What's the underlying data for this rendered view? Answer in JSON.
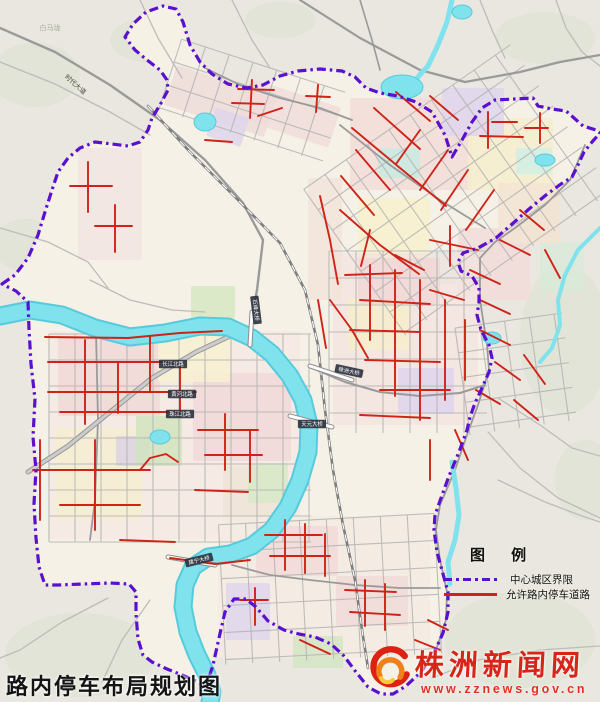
{
  "page": {
    "title": "路内停车布局规划图"
  },
  "legend": {
    "heading": "图 例",
    "items": [
      {
        "label": "中心城区界限",
        "type": "boundary"
      },
      {
        "label": "允许路内停车道路",
        "type": "parking-road"
      }
    ]
  },
  "watermark": {
    "site_name": "株洲新闻网",
    "url": "www.zznews.gov.cn"
  },
  "colors": {
    "bg_rural": "#e9e7e0",
    "blob": "#dee4d3",
    "urban_base": "#f7f2e7",
    "water_edge": "#55cbdb",
    "water": "#7fe2ec",
    "grid": "#b3b3b3",
    "rural_road": "#bcbcbc",
    "major_road": "#9a9a9a",
    "railway": "#7e7e7e",
    "red": "#cf2318",
    "boundary": "#5a10cf",
    "plate_bg": "#2e3440",
    "plate_text": "#ffffff"
  },
  "map": {
    "rural_blobs": [
      [
        35,
        75,
        45,
        32
      ],
      [
        95,
        195,
        38,
        48
      ],
      [
        25,
        245,
        32,
        26
      ],
      [
        150,
        40,
        40,
        22
      ],
      [
        545,
        38,
        50,
        26
      ],
      [
        565,
        340,
        45,
        75
      ],
      [
        520,
        640,
        75,
        48
      ],
      [
        80,
        655,
        75,
        42
      ],
      [
        585,
        480,
        30,
        40
      ],
      [
        280,
        20,
        35,
        18
      ]
    ],
    "boundary_path": "M2,284 L15,275 28,258 38,235 45,212 52,190 58,172 68,158 80,148 95,142 112,144 128,146 140,142 148,130 152,118 160,105 168,90 167,80 160,70 147,60 135,50 125,37 133,24 146,12 163,6 176,9 183,22 190,45 200,62 212,74 228,84 247,88 263,85 280,76 298,71 320,69 342,71 355,77 366,88 380,93 398,96 416,102 432,112 445,135 452,157 462,140 472,122 482,108 495,100 515,99 533,98 538,106 552,109 566,111 574,118 583,126 596,130 600,133 592,142 584,152 578,165 572,177 561,184 546,195 529,209 511,225 496,238 478,248 463,253 458,262 461,271 472,276 479,288 479,302 477,315 481,330 489,345 492,358 489,372 482,388 475,403 470,417 467,430 459,452 449,476 441,498 435,515 434,530 437,552 443,574 448,592 448,612 443,633 433,655 420,673 406,686 393,694 381,694 368,687 356,672 344,656 331,644 315,637 299,634 284,630 268,621 256,607 246,599 234,599 225,612 219,638 213,665 206,687 196,681 182,675 167,669 152,662 143,655 138,639 136,614 136,592 129,584 110,583 83,584 58,585 45,585 39,567 36,538 34,504 36,470 33,437 35,399 31,364 29,329 28,302 16,291 4,285 Z",
    "zones": [
      [
        350,
        98,
        122,
        92,
        "#f3dcd8",
        0
      ],
      [
        468,
        118,
        85,
        72,
        "#f6eecb",
        0
      ],
      [
        442,
        88,
        62,
        48,
        "#ded4ef",
        0
      ],
      [
        378,
        148,
        42,
        30,
        "#c6ebe2",
        0
      ],
      [
        424,
        252,
        46,
        32,
        "#c6ebe2",
        0
      ],
      [
        516,
        148,
        36,
        26,
        "#cfeee6",
        0
      ],
      [
        540,
        242,
        44,
        48,
        "#d9ead8",
        0
      ],
      [
        358,
        198,
        72,
        62,
        "#f7f0cc",
        0
      ],
      [
        458,
        228,
        72,
        72,
        "#f2dcda",
        0
      ],
      [
        498,
        183,
        62,
        60,
        "#f4e3d2",
        0
      ],
      [
        168,
        80,
        105,
        42,
        "#eedcda",
        18
      ],
      [
        242,
        92,
        95,
        42,
        "#f0dcda",
        18
      ],
      [
        210,
        112,
        36,
        30,
        "#ddd4ec",
        18
      ],
      [
        333,
        253,
        145,
        172,
        "#f4e4df",
        0
      ],
      [
        348,
        298,
        62,
        52,
        "#f6efcd",
        0
      ],
      [
        398,
        368,
        56,
        46,
        "#ded5ee",
        0
      ],
      [
        358,
        258,
        82,
        46,
        "#f0d7d5",
        0
      ],
      [
        48,
        331,
        252,
        208,
        "#f5e9e4",
        0
      ],
      [
        58,
        338,
        102,
        78,
        "#f1d8d6",
        0
      ],
      [
        193,
        373,
        98,
        88,
        "#f0d8d8",
        0
      ],
      [
        158,
        336,
        72,
        46,
        "#f7f1cf",
        0
      ],
      [
        56,
        428,
        86,
        92,
        "#f6efcf",
        0
      ],
      [
        116,
        436,
        34,
        30,
        "#d9d2e4",
        0
      ],
      [
        223,
        466,
        62,
        56,
        "#efe3d6",
        0
      ],
      [
        136,
        416,
        46,
        50,
        "#cfe4bd",
        0
      ],
      [
        191,
        286,
        44,
        34,
        "#d4e7c2",
        0
      ],
      [
        248,
        463,
        40,
        40,
        "#d6e8c4",
        0
      ],
      [
        218,
        516,
        212,
        142,
        "#f4ebe2",
        0
      ],
      [
        256,
        526,
        82,
        50,
        "#f1dad8",
        0
      ],
      [
        336,
        576,
        72,
        50,
        "#f0d9d7",
        0
      ],
      [
        226,
        583,
        44,
        57,
        "#ddd5ec",
        0
      ],
      [
        293,
        636,
        50,
        32,
        "#d2e5c3",
        0
      ],
      [
        308,
        178,
        34,
        122,
        "#f3e3da",
        0
      ],
      [
        78,
        148,
        64,
        112,
        "#f2e5e2",
        0
      ]
    ],
    "grids": [
      {
        "cx": 180,
        "cy": 438,
        "w": 262,
        "h": 208,
        "dx": 26,
        "dy": 26,
        "rot": 0
      },
      {
        "cx": 408,
        "cy": 342,
        "w": 158,
        "h": 182,
        "dx": 27,
        "dy": 27,
        "rot": 0
      },
      {
        "cx": 458,
        "cy": 190,
        "w": 252,
        "h": 178,
        "dx": 26,
        "dy": 25,
        "rot": -35
      },
      {
        "cx": 252,
        "cy": 101,
        "w": 172,
        "h": 74,
        "dx": 25,
        "dy": 24,
        "rot": 18
      },
      {
        "cx": 330,
        "cy": 589,
        "w": 216,
        "h": 140,
        "dx": 27,
        "dy": 27,
        "rot": -3
      },
      {
        "cx": 516,
        "cy": 374,
        "w": 108,
        "h": 108,
        "dx": 25,
        "dy": 25,
        "rot": -8
      }
    ],
    "rural_roads": [
      "0,62 55,84 110,112 150,135",
      "0,228 48,242 88,262 108,288",
      "140,0 158,38 182,78",
      "232,0 252,40 270,68",
      "480,0 492,30 505,58",
      "556,0 566,28 582,52 600,66",
      "488,432 520,468 558,498 600,518",
      "432,678 478,660 540,650 600,646",
      "108,598 62,622 20,650 0,658",
      "150,600 122,640 102,682",
      "90,280 130,300 172,310 205,312",
      "498,398 540,425 572,448 600,456",
      "498,480 545,502 582,516 600,522"
    ],
    "major_roads": [
      {
        "p": "0,28 55,52 110,85 160,120 205,160 243,203 263,240 257,290 252,318",
        "w": 2.4
      },
      {
        "p": "300,0 360,38 420,70 465,82 520,72 560,62 600,55",
        "w": 2.2
      },
      {
        "p": "585,145 570,180 545,205 515,228 495,242 480,258 480,300 487,345 489,370 478,405 468,432 455,470 440,505 436,530 440,560 447,592 446,620 436,650 420,672",
        "w": 1.8
      },
      {
        "p": "312,368 345,382 380,392 420,396 460,393 485,385",
        "w": 2
      },
      {
        "p": "96,332 98,420 95,500 90,540",
        "w": 1.8
      },
      {
        "p": "232,565 270,575 310,580 355,585 400,588 440,588",
        "w": 1.8
      },
      {
        "p": "205,68 240,85 280,98 320,108 352,120",
        "w": 1.8
      },
      {
        "p": "340,125 390,165 440,200 485,228",
        "w": 1.8
      },
      {
        "p": "360,0 372,40 380,70",
        "w": 1.6
      }
    ],
    "expressway": {
      "p": "28,472 68,446 110,412 152,378 196,352 230,336",
      "casing": "#999999",
      "fill_c": "#cccccc"
    },
    "railway": "148,106 190,152 238,200 280,243 305,290 318,345 325,410 333,470 343,525 355,580 362,630 368,668",
    "water": {
      "river": "0,316 30,310 62,315 95,328 130,337 165,333 200,326 228,327 252,338 272,354 290,376 303,400 309,425 308,452 300,480 288,507 272,530 252,546 230,554 208,557 193,567 185,585 183,607 188,632 197,655 207,675 212,692 210,702",
      "streams": [
        {
          "p": "600,228 578,250 565,275 558,300 560,325 552,348 540,362",
          "w": 4
        },
        {
          "p": "452,462 456,488 459,515 455,540 448,562 450,584",
          "w": 5
        },
        {
          "p": "452,0 447,22 438,45 428,66 416,79",
          "w": 5
        }
      ],
      "ponds": [
        [
          402,
          87,
          21,
          12
        ],
        [
          205,
          122,
          11,
          9
        ],
        [
          462,
          12,
          10,
          7
        ],
        [
          160,
          437,
          10,
          7
        ],
        [
          492,
          338,
          9,
          6
        ],
        [
          545,
          160,
          10,
          6
        ]
      ]
    },
    "bridges": [
      "252,312 250,345",
      "310,366 352,380",
      "290,416 332,427",
      "168,557 215,565"
    ],
    "red_roads": [
      "45,337 128,338 180,333 222,331",
      "48,362 178,362",
      "48,392 196,392",
      "60,412 190,412",
      "85,340 85,424",
      "118,362 118,413",
      "150,337 150,392",
      "180,362 180,413",
      "60,470 150,470",
      "95,440 95,530",
      "60,505 140,505",
      "140,470 150,458 166,454 178,462",
      "198,430 258,430",
      "205,455 262,455",
      "225,414 225,470",
      "250,430 250,482",
      "195,490 248,492",
      "40,440 40,520",
      "33,470 60,470",
      "88,162 88,212",
      "70,186 112,186",
      "95,226 132,226",
      "115,205 115,252",
      "205,140 232,142",
      "120,540 175,542",
      "252,80 250,118",
      "238,89 274,90",
      "232,103 264,104",
      "258,116 282,108",
      "318,85 316,112",
      "306,96 330,97",
      "352,128 400,168 446,206",
      "374,108 420,149",
      "396,92 430,121",
      "420,130 396,164",
      "448,150 420,190",
      "468,170 441,210",
      "494,190 466,230",
      "356,150 390,190",
      "341,176 374,215",
      "430,96 458,120",
      "480,136 523,137",
      "492,122 517,122",
      "488,112 488,148",
      "540,113 540,143",
      "525,128 548,128",
      "340,210 380,245 419,274",
      "370,230 361,266",
      "395,255 424,270",
      "430,240 478,250",
      "450,226 450,266",
      "470,270 500,284",
      "500,240 530,255",
      "520,210 544,230",
      "545,250 560,278",
      "480,300 510,314",
      "430,290 464,300",
      "345,275 402,273",
      "360,300 430,304",
      "350,330 420,332",
      "365,360 440,362",
      "380,390 450,390",
      "360,415 430,418",
      "370,265 370,340",
      "395,270 395,396",
      "420,280 420,420",
      "445,300 445,400",
      "465,320 465,380",
      "330,300 352,330 368,358",
      "320,196 330,240 338,284",
      "318,300 326,348",
      "455,430 468,460",
      "430,440 430,480",
      "480,330 510,345",
      "495,362 520,380",
      "476,390 500,404",
      "524,355 545,384",
      "514,400 538,420",
      "170,558 215,564 250,560",
      "265,535 322,535",
      "270,556 330,556",
      "285,520 285,570",
      "305,524 305,573",
      "325,534 325,576",
      "345,590 396,592",
      "350,612 400,615",
      "365,580 365,626",
      "385,584 385,630",
      "240,600 268,600",
      "255,588 255,625",
      "300,640 330,654",
      "415,640 440,650",
      "428,620 448,630"
    ],
    "plates": [
      {
        "t": "长江北路",
        "x": 173,
        "y": 364,
        "r": 0
      },
      {
        "t": "黄河北路",
        "x": 182,
        "y": 394,
        "r": 0
      },
      {
        "t": "珠江北路",
        "x": 180,
        "y": 414,
        "r": 0
      },
      {
        "t": "株洲大桥",
        "x": 349,
        "y": 371,
        "r": 12
      },
      {
        "t": "天元大桥",
        "x": 312,
        "y": 424,
        "r": 0
      },
      {
        "t": "建宁大桥",
        "x": 199,
        "y": 560,
        "r": -14
      },
      {
        "t": "石峰大桥",
        "x": 256,
        "y": 310,
        "r": 83
      }
    ],
    "labels": [
      {
        "t": "时代大道",
        "x": 74,
        "y": 86,
        "s": 6.5,
        "c": "#4a4a42",
        "r": 42
      },
      {
        "t": "白马垅",
        "x": 50,
        "y": 30,
        "s": 7,
        "c": "#a8ad9a",
        "r": 0
      }
    ]
  }
}
